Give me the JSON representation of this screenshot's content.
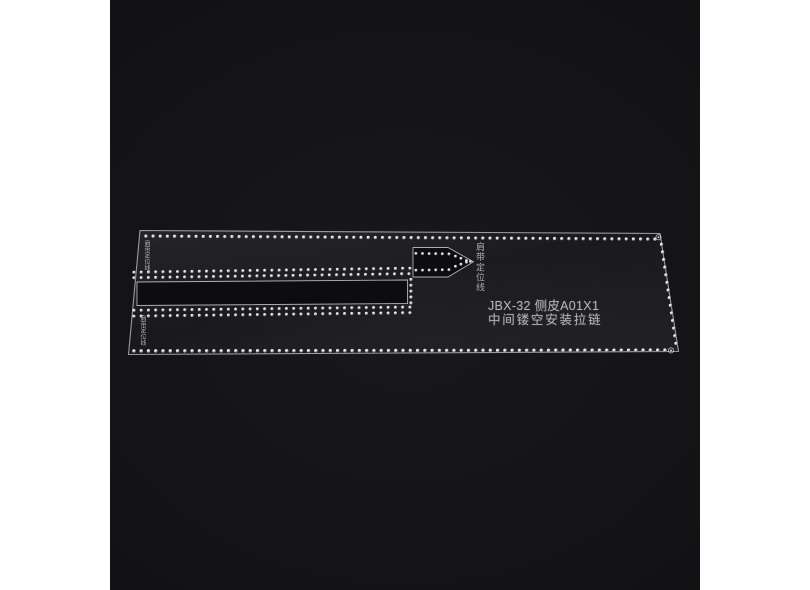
{
  "photo": {
    "margin_color": "#ffffff",
    "background_color": "#141417"
  },
  "engraving": {
    "line_color": "rgba(240,240,246,0.6)",
    "hole_highlight": "#ffffff",
    "hole_shadow": "#55555c",
    "text_color": "#aeaeb5"
  },
  "template_text": {
    "model_line": "JBX-32 侧皮A01X1",
    "description_line": "中间镂空安装拉链",
    "label_top_left": "肩带定位线",
    "label_bottom_left": "肩带定位线",
    "label_arrow": "肩带定位线"
  },
  "geometry": {
    "outline": "M140,230.5 L660,233.5 L678.5,351.5 L128.5,354.5 Z",
    "slot": "M137,282 L407.5,280 L407.5,303.5 L137,305.5 Z",
    "arrow": "M413,247.5 L448,247.5 L473.5,261.8 L448,277 L413,277 Z",
    "stitch_runs": [
      {
        "name": "top-border-stitch-row",
        "x1": 146,
        "y1": 236.2,
        "x2": 655,
        "y2": 239.2,
        "n": 72,
        "r": 1.7
      },
      {
        "name": "bottom-border-stitch-row",
        "x1": 134,
        "y1": 351,
        "x2": 665,
        "y2": 350.2,
        "n": 74,
        "r": 1.8
      },
      {
        "name": "right-border-stitch-column",
        "x1": 661.5,
        "y1": 244.5,
        "x2": 676,
        "y2": 343.5,
        "n": 14,
        "r": 1.7
      },
      {
        "name": "slot-upper-stitch-row-outer",
        "x1": 134,
        "y1": 272.3,
        "x2": 410,
        "y2": 268.3,
        "n": 39,
        "r": 1.6
      },
      {
        "name": "slot-upper-stitch-row-inner",
        "x1": 134,
        "y1": 277.8,
        "x2": 409,
        "y2": 273.8,
        "n": 39,
        "r": 1.6
      },
      {
        "name": "slot-lower-stitch-row-inner",
        "x1": 134,
        "y1": 310.4,
        "x2": 410,
        "y2": 307.2,
        "n": 39,
        "r": 1.6
      },
      {
        "name": "slot-lower-stitch-row-outer",
        "x1": 134,
        "y1": 316.2,
        "x2": 410,
        "y2": 312.8,
        "n": 39,
        "r": 1.6
      },
      {
        "name": "slot-end-wrap-column",
        "x1": 411,
        "y1": 279.5,
        "x2": 411,
        "y2": 303,
        "n": 5,
        "r": 1.6
      },
      {
        "name": "arrow-top-stitch-row",
        "x1": 416,
        "y1": 253.5,
        "x2": 449,
        "y2": 254,
        "n": 6,
        "r": 1.5
      },
      {
        "name": "arrow-top-converge-row",
        "x1": 455.5,
        "y1": 256.2,
        "x2": 466.5,
        "y2": 260.6,
        "n": 3,
        "r": 1.5
      },
      {
        "name": "arrow-bottom-stitch-row",
        "x1": 416,
        "y1": 270.3,
        "x2": 449,
        "y2": 269.8,
        "n": 6,
        "r": 1.5
      },
      {
        "name": "arrow-bottom-converge-row",
        "x1": 455.5,
        "y1": 266.4,
        "x2": 466.5,
        "y2": 262.2,
        "n": 3,
        "r": 1.5
      },
      {
        "name": "arrow-tip-hole",
        "x1": 470.5,
        "y1": 261.5,
        "x2": 470.5,
        "y2": 261.5,
        "n": 1,
        "r": 1.5
      }
    ],
    "corner_marks": [
      {
        "name": "top-right-corner-hole",
        "cx": 658.5,
        "cy": 237.3,
        "r": 2.6
      },
      {
        "name": "bottom-right-corner-hole",
        "cx": 671,
        "cy": 350.4,
        "r": 2.6
      }
    ]
  }
}
